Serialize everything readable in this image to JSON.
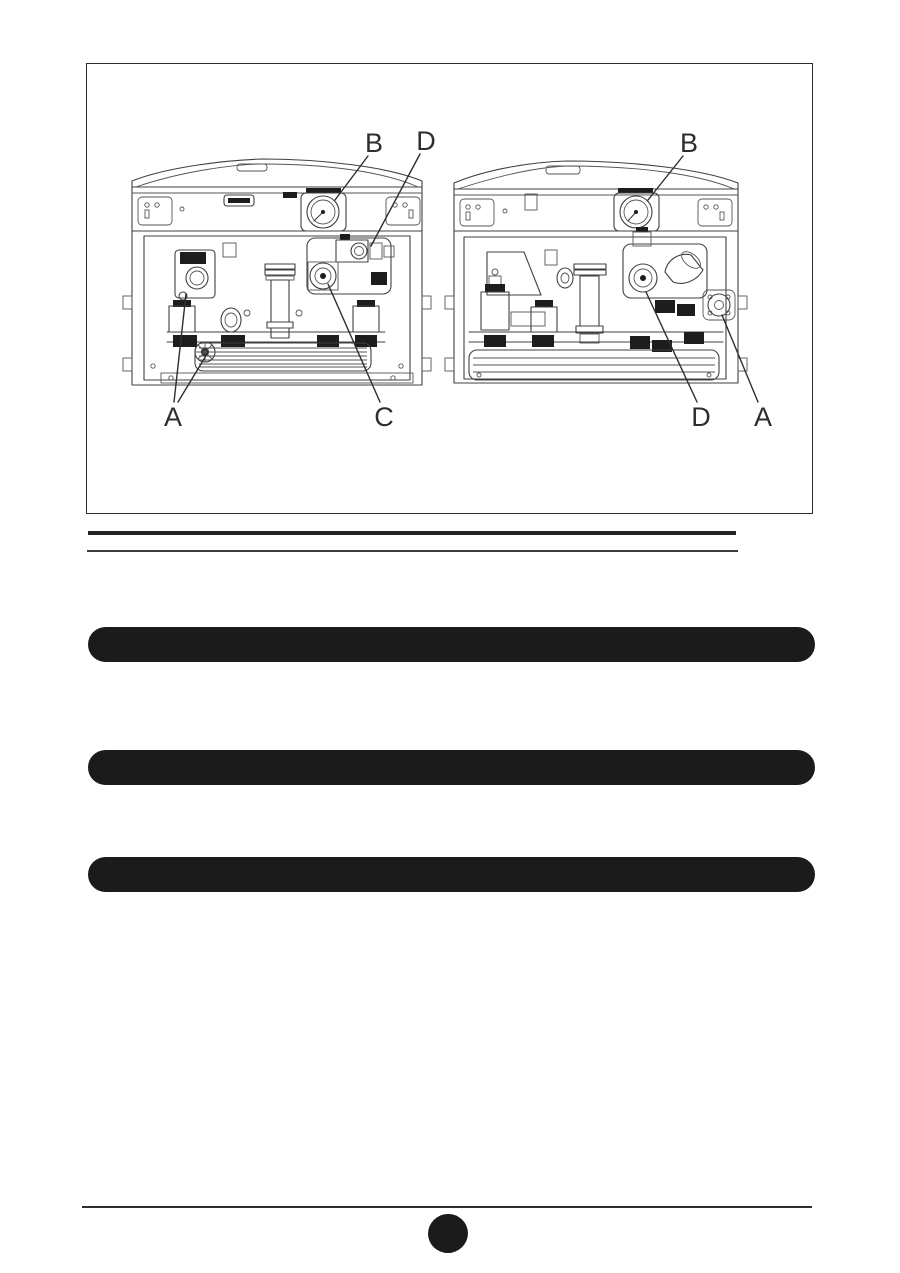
{
  "page": {
    "background_color": "#ffffff",
    "ink_color": "#1b1b1b"
  },
  "figure": {
    "frame": "rectangular border",
    "views": [
      {
        "name": "left boiler internal view",
        "callouts": [
          {
            "letter": "B"
          },
          {
            "letter": "D"
          },
          {
            "letter": "A"
          },
          {
            "letter": "C"
          }
        ]
      },
      {
        "name": "right boiler internal view",
        "callouts": [
          {
            "letter": "B"
          },
          {
            "letter": "D"
          },
          {
            "letter": "A"
          }
        ]
      }
    ]
  },
  "rules": {
    "double_rule_color": "#2b2b2b",
    "footer_rule_color": "#2e2e2e"
  },
  "redacted_bars": {
    "count": 3,
    "color": "#1b1b1b"
  },
  "page_marker": {
    "shape": "filled-ellipse",
    "color": "#1b1b1b"
  }
}
